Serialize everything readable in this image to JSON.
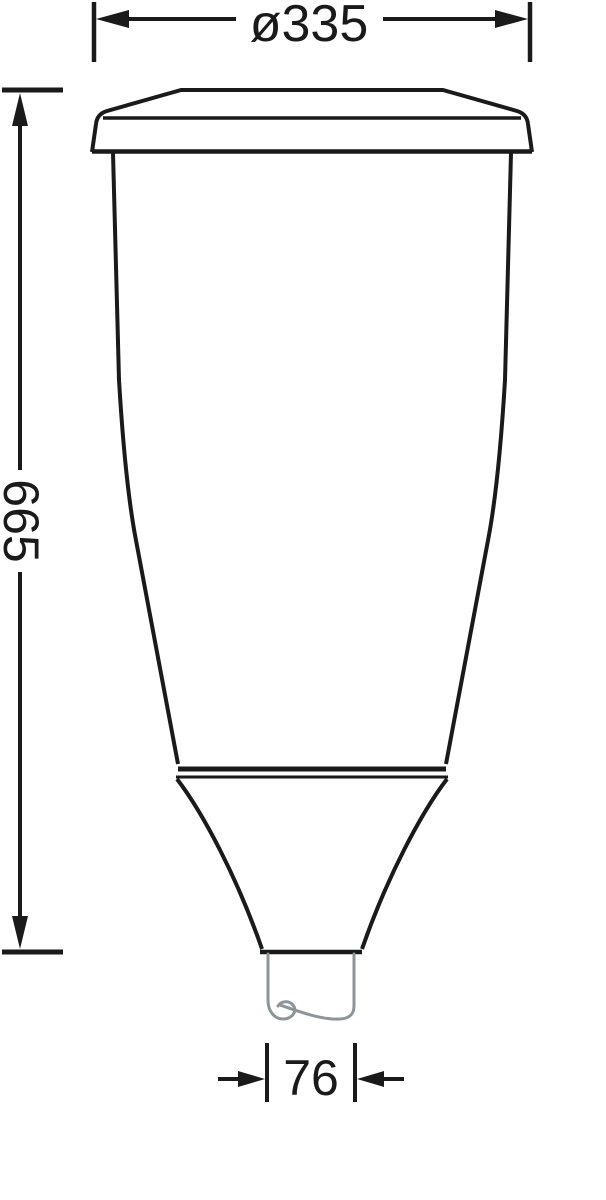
{
  "drawing": {
    "background_color": "#ffffff",
    "outline_color": "#1a1a1a",
    "pole_color": "#8d9599",
    "dimensions": {
      "diameter": {
        "label": "ø335",
        "value": 335
      },
      "height": {
        "label": "665",
        "value": 665
      },
      "spigot": {
        "label": "76",
        "value": 76
      }
    }
  }
}
